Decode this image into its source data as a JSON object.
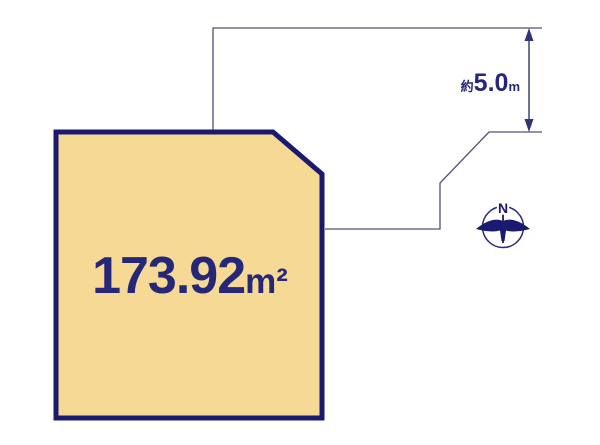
{
  "plot": {
    "area_value": "173.92",
    "area_unit": "m²",
    "fill_color": "#F6D995",
    "border_color": "#1A1A70"
  },
  "dimension": {
    "prefix": "約",
    "value": "5.0",
    "unit": "m"
  },
  "compass": {
    "north_label": "N"
  },
  "colors": {
    "background": "#FFFFFF",
    "road_line": "#50507A",
    "dimension_line": "#333377",
    "label_text": "#252878"
  }
}
